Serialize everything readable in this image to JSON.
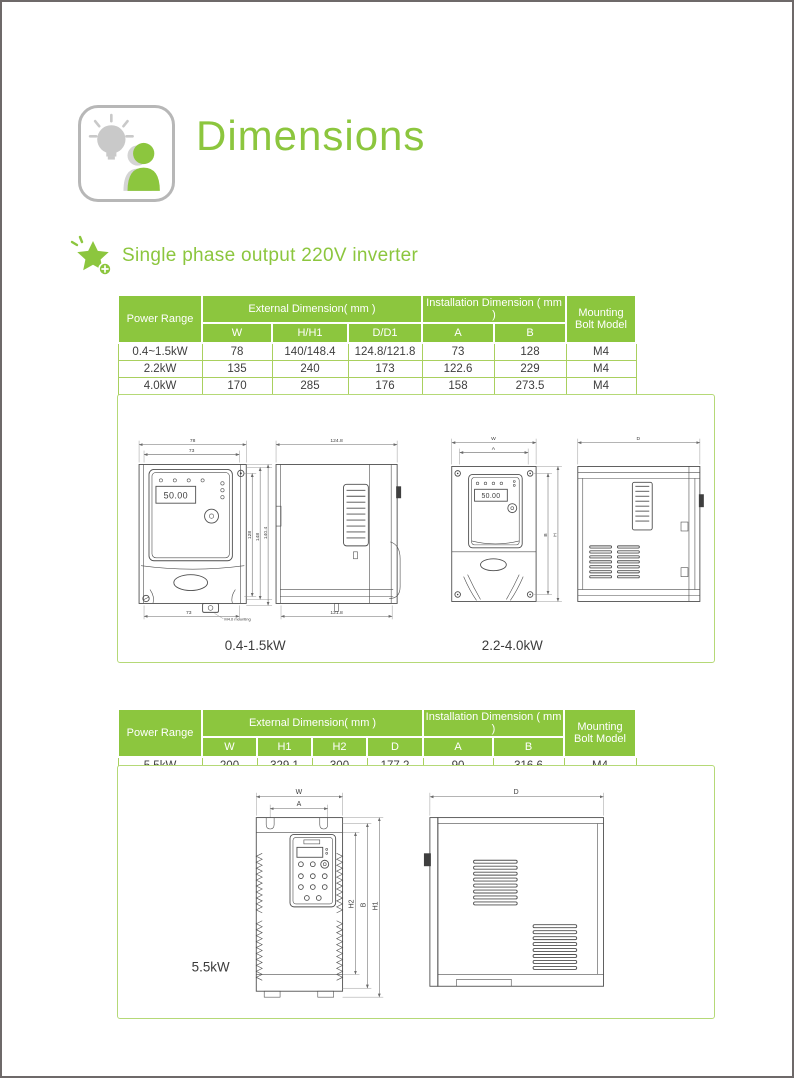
{
  "page": {
    "title": "Dimensions",
    "section_heading": "Single phase output 220V inverter"
  },
  "colors": {
    "accent_green": "#8cc63e",
    "table_header_bg": "#8cc63e",
    "table_border_light": "#a9d05e",
    "drawing_box_border": "#b5d977",
    "page_border": "#6e6969"
  },
  "icons": {
    "brand_icon": "lightbulb-person-icon",
    "bullet_icon": "star-plus-icon"
  },
  "table1": {
    "power_range_header": "Power Range",
    "external_group_header": "External Dimension( mm )",
    "installation_group_header": "Installation Dimension ( mm )",
    "mounting_header_line1": "Mounting",
    "mounting_header_line2": "Bolt Model",
    "subheaders": [
      "W",
      "H/H1",
      "D/D1",
      "A",
      "B"
    ],
    "rows": [
      [
        "0.4~1.5kW",
        "78",
        "140/148.4",
        "124.8/121.8",
        "73",
        "128",
        "M4"
      ],
      [
        "2.2kW",
        "135",
        "240",
        "173",
        "122.6",
        "229",
        "M4"
      ],
      [
        "4.0kW",
        "170",
        "285",
        "176",
        "158",
        "273.5",
        "M4"
      ]
    ]
  },
  "table2": {
    "power_range_header": "Power Range",
    "external_group_header": "External Dimension( mm )",
    "installation_group_header": "Installation Dimension ( mm )",
    "mounting_header_line1": "Mounting",
    "mounting_header_line2": "Bolt Model",
    "subheaders": [
      "W",
      "H1",
      "H2",
      "D",
      "A",
      "B"
    ],
    "rows": [
      [
        "5.5kW",
        "200",
        "329.1",
        "300",
        "177.2",
        "90",
        "316.6",
        "M4"
      ]
    ]
  },
  "drawings_small": {
    "caption_left": "0.4-1.5kW",
    "caption_right": "2.2-4.0kW",
    "front_small": {
      "dim_width_outer": "78",
      "dim_width_inner": "73",
      "dim_height_inner": "128",
      "dim_height_mid": "148",
      "dim_height_outer": "140.4",
      "dim_bottom_width": "73",
      "mounting_note": "M4.0 mounting",
      "display_value": "50.00"
    },
    "side_small": {
      "dim_depth_top": "124.8",
      "dim_depth_bottom": "121.8"
    },
    "front_mid": {
      "dim_width_outer": "W",
      "dim_width_inner": "A",
      "dim_height_inner": "B",
      "dim_height_outer": "H",
      "display_value": "50.00"
    },
    "side_mid": {
      "dim_depth": "D"
    }
  },
  "drawings_large": {
    "caption": "5.5kW",
    "front": {
      "dim_width_outer": "W",
      "dim_width_inner": "A",
      "dim_h2": "H2",
      "dim_b": "B",
      "dim_h1": "H1"
    },
    "side": {
      "dim_depth": "D"
    }
  }
}
